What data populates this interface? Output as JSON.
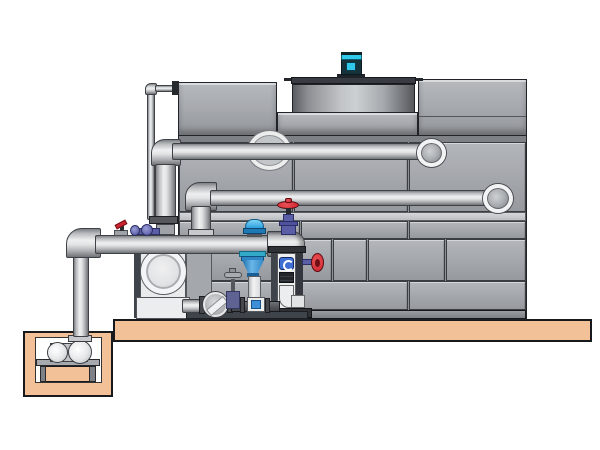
{
  "meta": {
    "description": "CAD-style side elevation of a closed-circuit cooling tower with external piping, pump skid, valve stand and remote sump pit",
    "visible_text": []
  },
  "palette": {
    "background": "#ffffff",
    "panel_face": "#a6a9ae",
    "panel_face_dark": "#96999e",
    "panel_seam": "#3a3d42",
    "panel_band_light": "#c9ccd0",
    "tank_outline": "#202327",
    "pipe_outline": "#3e4145",
    "slab_tan": "#f2c197",
    "slab_outline": "#17191c",
    "motor_cyan": "#2fc9ec",
    "motor_body_dark": "#16333c",
    "handwheel_red": "#ce2430",
    "valve_purple": "#5a5ea6",
    "actuator_blue": "#2d9fe0",
    "cone_blue": "#2f86c5",
    "gauge_blue": "#3e6ed4",
    "frame_dark": "#3f434a",
    "pump_white": "#e9eaec"
  },
  "components": {
    "civil": {
      "slab": "concrete-foundation-slab",
      "sump_pit": "remote-sump-pit",
      "platform": "sump-pump-support-platform"
    },
    "tower": {
      "body": "paneled cooling tower casing",
      "left_plenum": "left top plenum box",
      "right_plenum": "right top plenum box",
      "fan_shroud": "recessed fan cowl",
      "fan_motor": "cyan fan motor",
      "base_channel": "tower base channel"
    },
    "piping": {
      "upper_pipe": "upper horizontal inlet pipe",
      "middle_pipe": "middle horizontal return pipe",
      "suction_header": "pump skid suction header",
      "standpipe": "left vertical standpipe",
      "makeup_line": "thin makeup water line",
      "sump_riser": "sump riser pipe"
    },
    "equipment": {
      "main_pump": "end-suction centrifugal pump",
      "sump_pump": "horizontal sump pump set",
      "valve_stand": "instrument and valve stand frame",
      "cone_diffuser": "blue suction diffuser cone",
      "check_valve": "wafer check valve",
      "inline_gate_valve": "inline gate valve with top handwheel",
      "top_gate_valve": "red handwheel gate valve",
      "actuated_butterfly": "blue actuated butterfly valve",
      "side_handwheel_valve": "red side handwheel valve",
      "lever_valve": "red lever ball valve"
    }
  }
}
